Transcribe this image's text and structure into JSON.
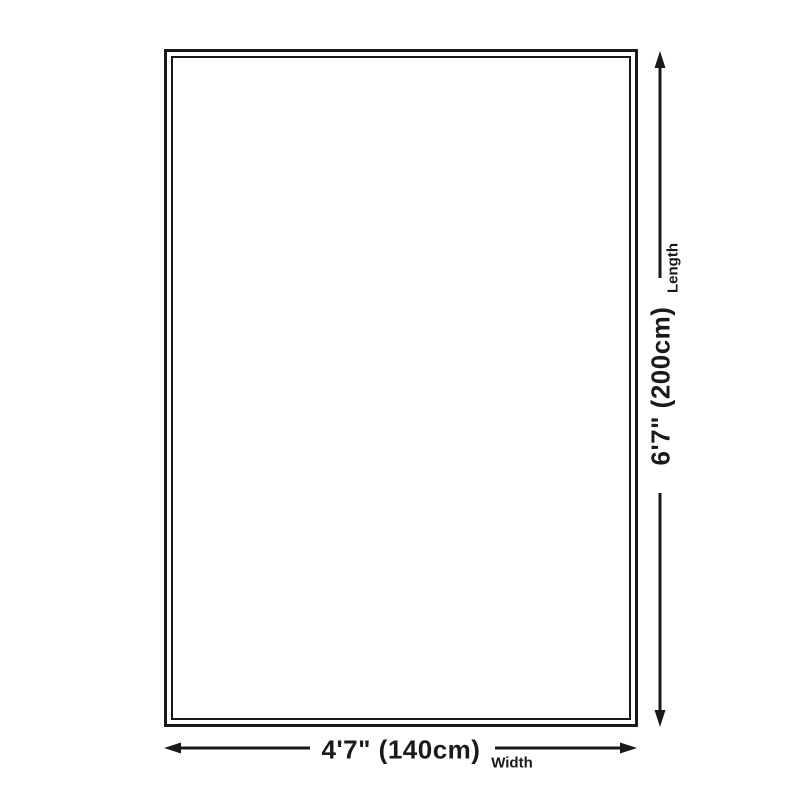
{
  "colors": {
    "background": "#ffffff",
    "line": "#1a1a1a",
    "text": "#1a1a1a"
  },
  "dimensions": {
    "length": {
      "value": "6'7\" (200cm)",
      "label": "Length"
    },
    "width": {
      "value": "4'7\" (140cm)",
      "label": "Width"
    }
  }
}
